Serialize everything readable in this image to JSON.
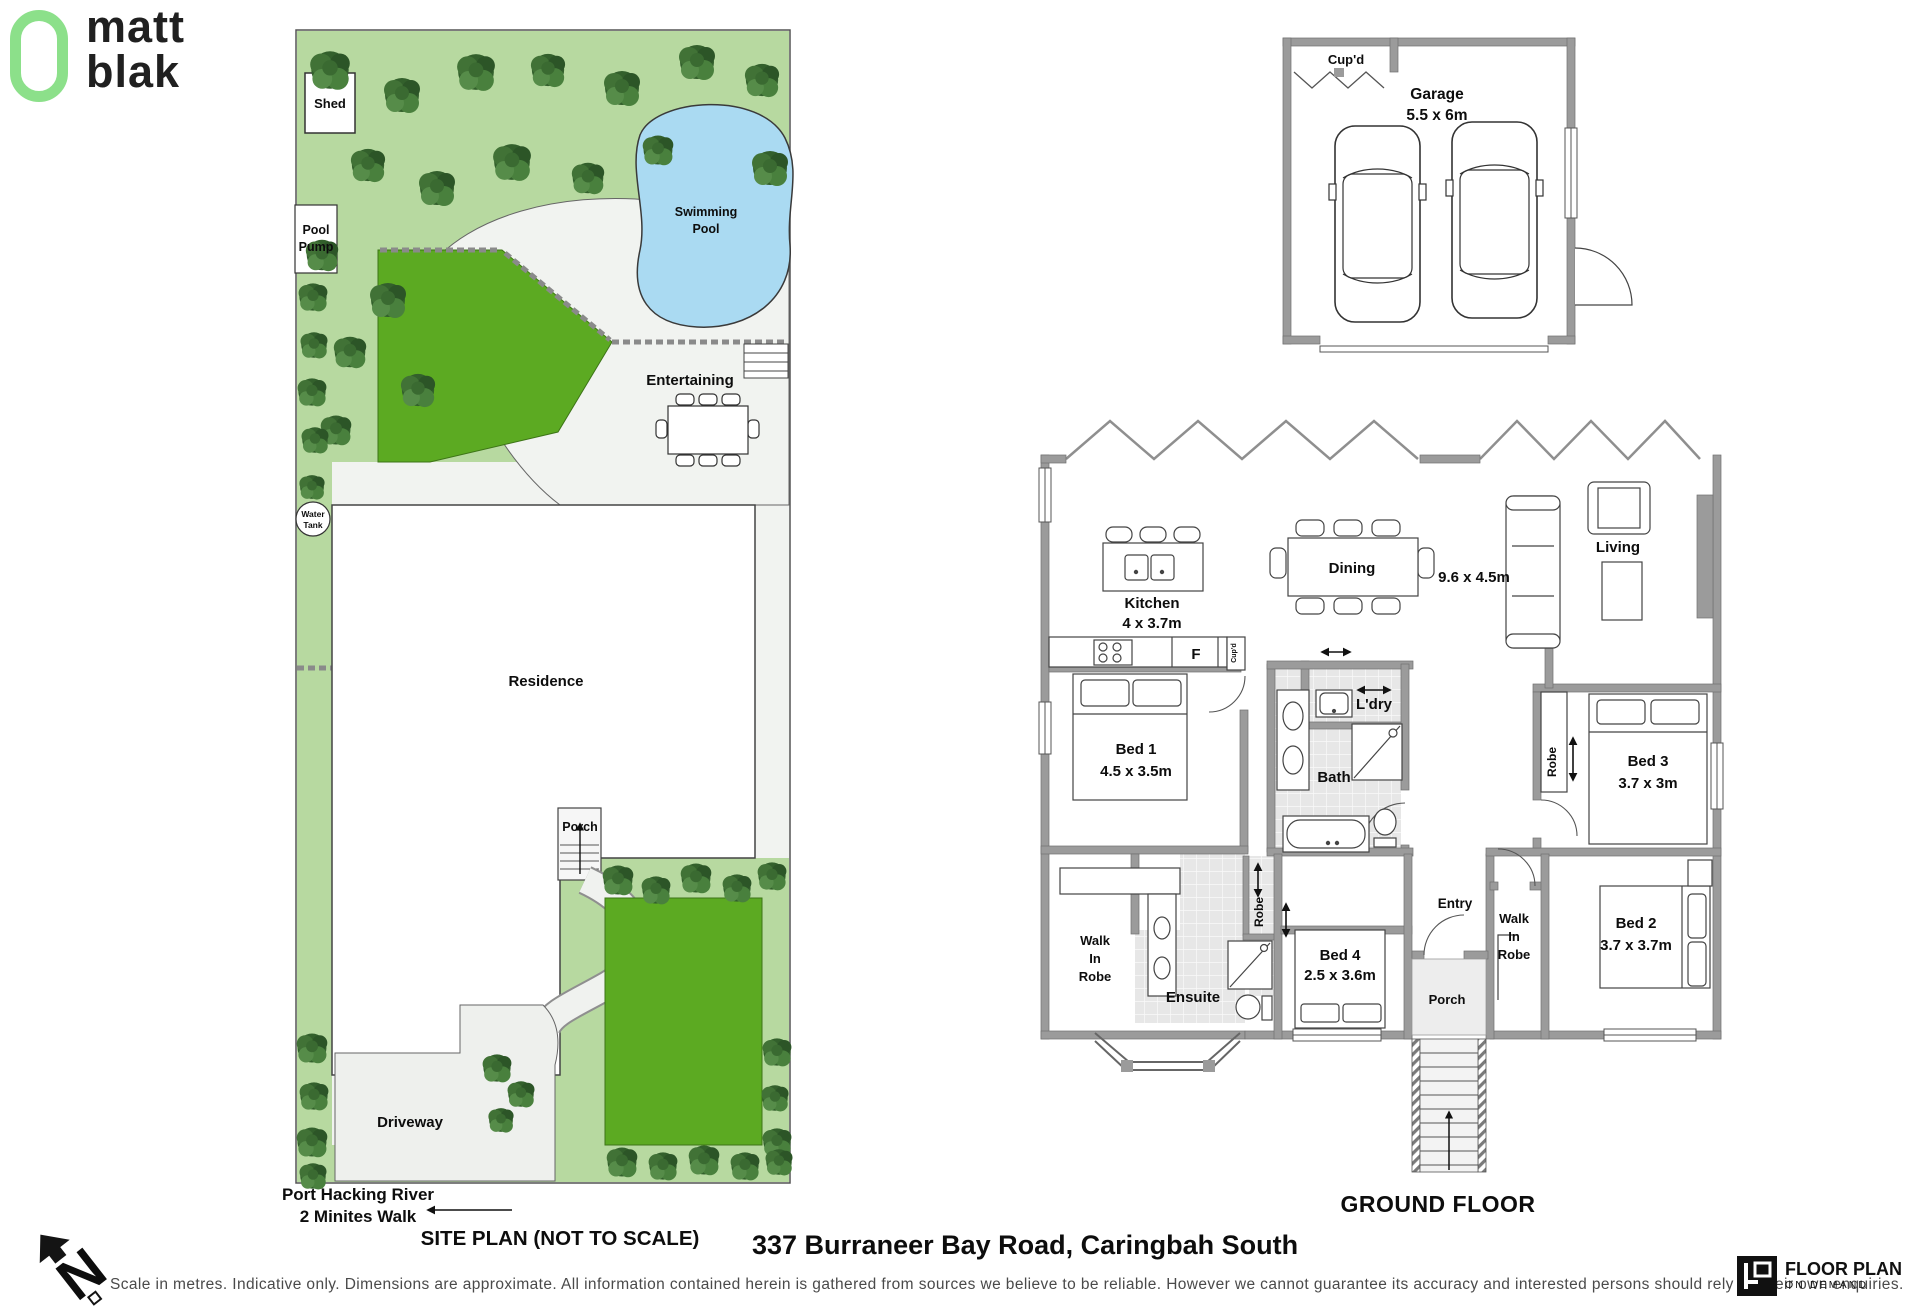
{
  "header": {
    "brand_top": "matt",
    "brand_bottom": "blak"
  },
  "site_plan": {
    "labels": {
      "shed": "Shed",
      "pool_pump_l1": "Pool",
      "pool_pump_l2": "Pump",
      "swimming_pool_l1": "Swimming",
      "swimming_pool_l2": "Pool",
      "entertaining": "Entertaining",
      "water_tank_l1": "Water",
      "water_tank_l2": "Tank",
      "residence": "Residence",
      "porch": "Porch",
      "driveway": "Driveway",
      "river_l1": "Port Hacking River",
      "river_l2": "2 Minites Walk",
      "caption": "SITE PLAN (NOT TO SCALE)"
    }
  },
  "garage": {
    "cupboard": "Cup'd",
    "name": "Garage",
    "size": "5.5 x 6m"
  },
  "floor_plan": {
    "title": "GROUND FLOOR",
    "rooms": {
      "kitchen": {
        "name": "Kitchen",
        "size": "4 x 3.7m"
      },
      "dining": {
        "name": "Dining"
      },
      "living": {
        "name": "Living"
      },
      "living_dining_size": "9.6 x 4.5m",
      "fridge": "F",
      "cupboard": "Cup'd",
      "laundry": "L'dry",
      "bed1": {
        "name": "Bed 1",
        "size": "4.5 x 3.5m"
      },
      "bath": {
        "name": "Bath"
      },
      "robe_hall": "Robe",
      "bed3": {
        "name": "Bed 3",
        "size": "3.7 x 3m",
        "robe": "Robe"
      },
      "wir1": {
        "l1": "Walk",
        "l2": "In",
        "l3": "Robe"
      },
      "ensuite": "Ensuite",
      "bed4": {
        "name": "Bed 4",
        "size": "2.5 x 3.6m"
      },
      "entry": "Entry",
      "wir2": {
        "l1": "Walk",
        "l2": "In",
        "l3": "Robe"
      },
      "bed2": {
        "name": "Bed 2",
        "size": "3.7 x 3.7m"
      },
      "porch": "Porch"
    }
  },
  "footer": {
    "address": "337 Burraneer Bay Road, Caringbah South",
    "disclaimer": "Scale in metres. Indicative only. Dimensions are approximate. All information contained herein is gathered from sources we believe to be reliable. However we cannot guarantee its accuracy and interested persons should rely on their own enquiries.",
    "fpod_l1": "FLOOR PLAN",
    "fpod_l2": "ON DEMAND",
    "north": "N"
  },
  "colors": {
    "brand_green": "#8ce08a",
    "pale_green": "#b7d9a0",
    "lawn_green": "#5caa22",
    "pool_blue": "#aadaf2",
    "wall_gray": "#9b9b9b"
  }
}
